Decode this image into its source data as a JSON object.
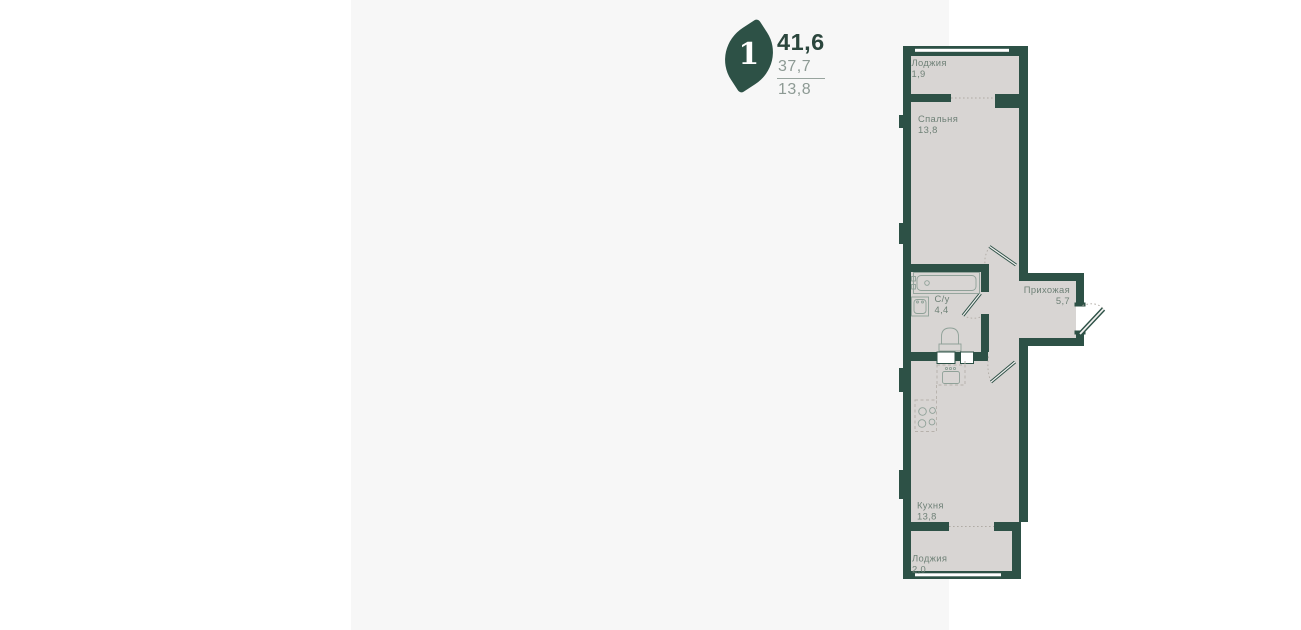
{
  "card": {
    "badge": {
      "rooms_count": "1",
      "icon": "leaf-icon"
    },
    "areas": {
      "total": "41,6",
      "living": "37,7",
      "kitchen": "13,8"
    }
  },
  "plan": {
    "rooms": [
      {
        "id": "loggia-top",
        "name": "Лоджия",
        "area": "1,9"
      },
      {
        "id": "bedroom",
        "name": "Спальня",
        "area": "13,8"
      },
      {
        "id": "bathroom",
        "name": "С/у",
        "area": "4,4"
      },
      {
        "id": "hallway",
        "name": "Прихожая",
        "area": "5,7"
      },
      {
        "id": "kitchen",
        "name": "Кухня",
        "area": "13,8"
      },
      {
        "id": "loggia-bottom",
        "name": "Лоджия",
        "area": "2,0"
      }
    ]
  },
  "colors": {
    "wall": "#2d5146",
    "floor": "#d8d5d3",
    "panel_background": "#f7f7f7",
    "page_background": "#ffffff",
    "fixture_stroke": "#8fa198",
    "dashed_stroke": "#b6b1ab",
    "room_label": "#6f8177",
    "total_area_text": "#2b463d",
    "secondary_area_text": "#8d9a94"
  }
}
